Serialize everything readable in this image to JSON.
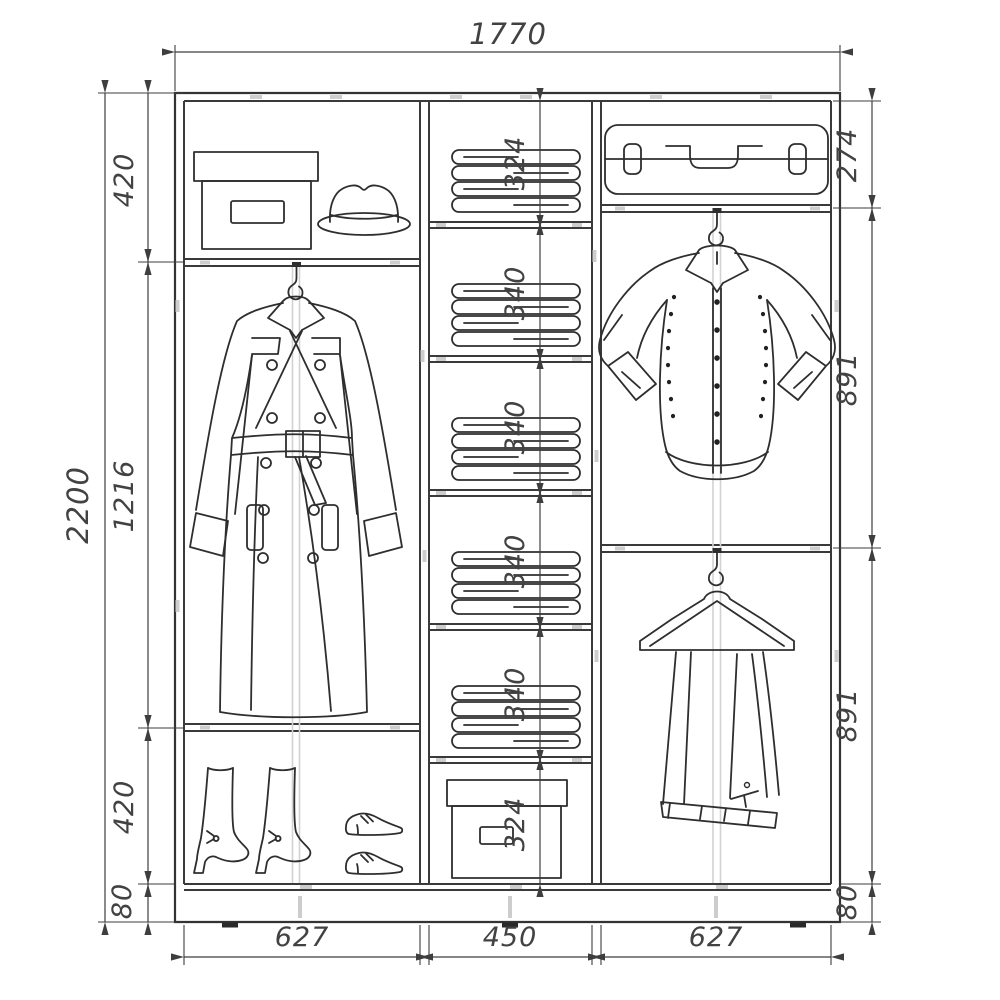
{
  "dims": {
    "overall_width": "1770",
    "overall_height": "2200",
    "left_chain": [
      "420",
      "1216",
      "420",
      "80"
    ],
    "middle_chain": [
      "324",
      "340",
      "340",
      "340",
      "340",
      "324"
    ],
    "right_chain": [
      "274",
      "891",
      "891",
      "80"
    ],
    "bottom_chain": [
      "627",
      "450",
      "627"
    ]
  },
  "items": [
    "storage-box",
    "fedora-hat",
    "trench-coat",
    "pair-of-boots",
    "pair-of-shoes",
    "folded-linen-stack",
    "folded-linen-stack",
    "folded-linen-stack",
    "folded-linen-stack",
    "folded-linen-stack",
    "storage-box",
    "suitcase",
    "shirt-on-hook",
    "trousers-on-hanger"
  ],
  "colors": {
    "line": "#333333",
    "dimension": "#3e3e3e",
    "secondary": "#cdcdcd",
    "background": "#ffffff"
  }
}
